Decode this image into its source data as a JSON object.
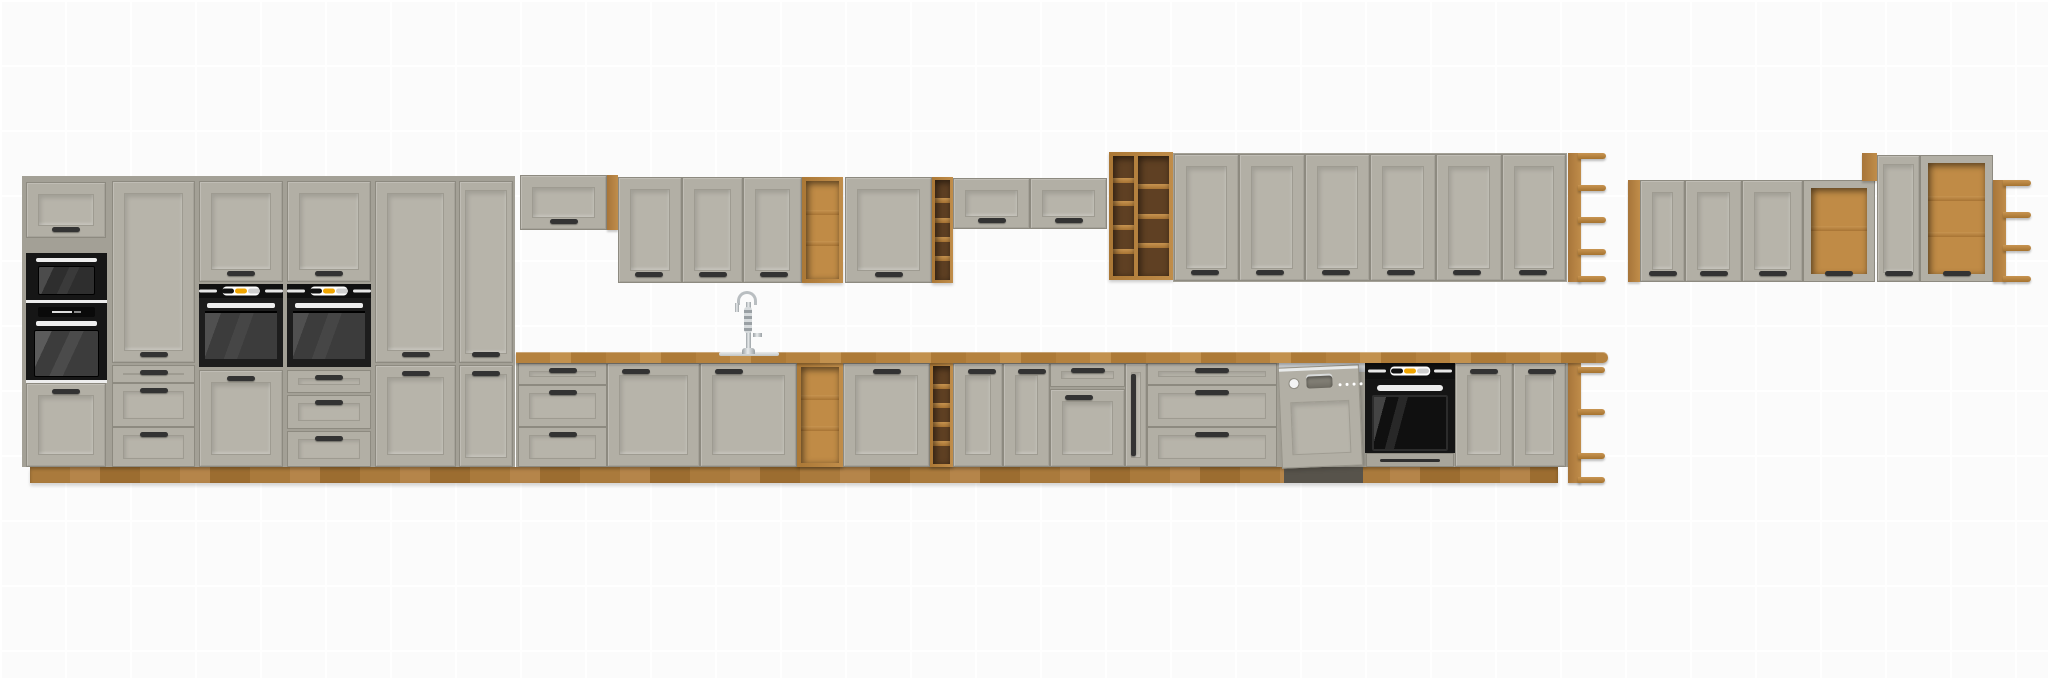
{
  "scene": {
    "type": "kitchen-furniture-render",
    "regions": [
      "tall-cabinet-block",
      "mid-wall-cabinets",
      "base-cabinet-run",
      "right-wall-cabinet-group"
    ],
    "appliances": [
      "microwave",
      "compact-oven",
      "built-in-oven-left",
      "built-in-oven-right",
      "dishwasher",
      "base-built-in-oven",
      "sink-faucet"
    ]
  },
  "palette": {
    "bg": "#fbfbfb",
    "grid": "#ffffff",
    "front": "#b2afa5",
    "front2": "#b7b4aa",
    "edge": "#8d8a80",
    "carcass": "#a3a096",
    "oak": "#b5823f",
    "oak_light": "#c89350",
    "oak_dark": "#9c6f33",
    "oak_int": "#c08b46",
    "oak_int_dark": "#5f4023",
    "plinth": "#aa7a3c",
    "handle": "#333333",
    "black": "#181818",
    "win": "#3c3c3c",
    "white_trim": "#eeeeee",
    "orange": "#f0a500",
    "steel": "#c9cdd0",
    "steel_dark": "#9aa0a4",
    "dw_gap": "#57534b"
  }
}
